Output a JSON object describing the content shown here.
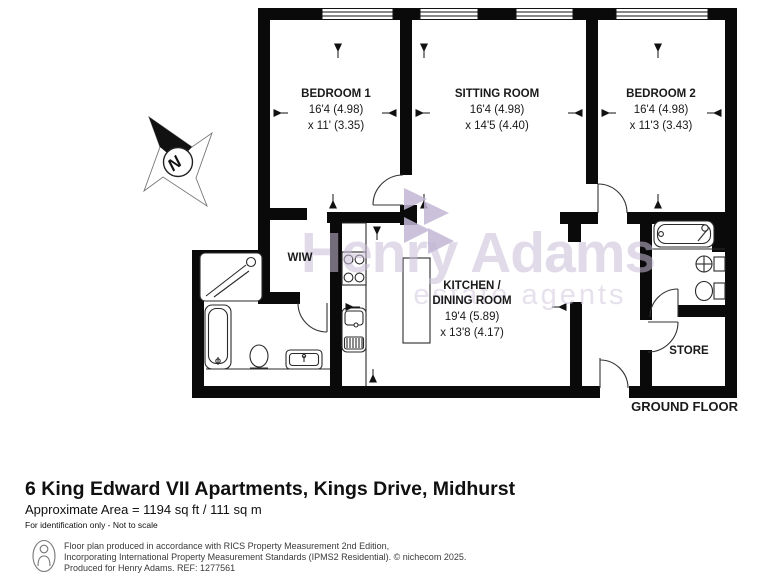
{
  "plan": {
    "floor_label": "GROUND FLOOR",
    "compass": {
      "letter": "N"
    },
    "watermark": {
      "line1": "Henry Adams",
      "line2": "estate agents",
      "color": "#c8bdd8",
      "color2": "#d2c9de"
    },
    "rooms": [
      {
        "name": "BEDROOM 1",
        "dim1": "16'4 (4.98)",
        "dim2": "x 11' (3.35)"
      },
      {
        "name": "SITTING ROOM",
        "dim1": "16'4 (4.98)",
        "dim2": "x 14'5 (4.40)"
      },
      {
        "name": "BEDROOM 2",
        "dim1": "16'4 (4.98)",
        "dim2": "x 11'3 (3.43)"
      },
      {
        "name": "KITCHEN /",
        "name2": "DINING ROOM",
        "dim1": "19'4 (5.89)",
        "dim2": "x 13'8 (4.17)"
      },
      {
        "name": "WIW"
      },
      {
        "name": "STORE"
      }
    ]
  },
  "title_block": {
    "address": "6 King Edward VII Apartments, Kings Drive, Midhurst",
    "area": "Approximate Area = 1194 sq ft / 111 sq m",
    "note": "For identification only - Not to scale"
  },
  "footer": {
    "line1": "Floor plan produced in accordance with RICS Property Measurement 2nd Edition,",
    "line2": "Incorporating International Property Measurement Standards (IPMS2 Residential).   © nichecom 2025.",
    "line3": "Produced for Henry Adams.    REF: 1277561"
  }
}
